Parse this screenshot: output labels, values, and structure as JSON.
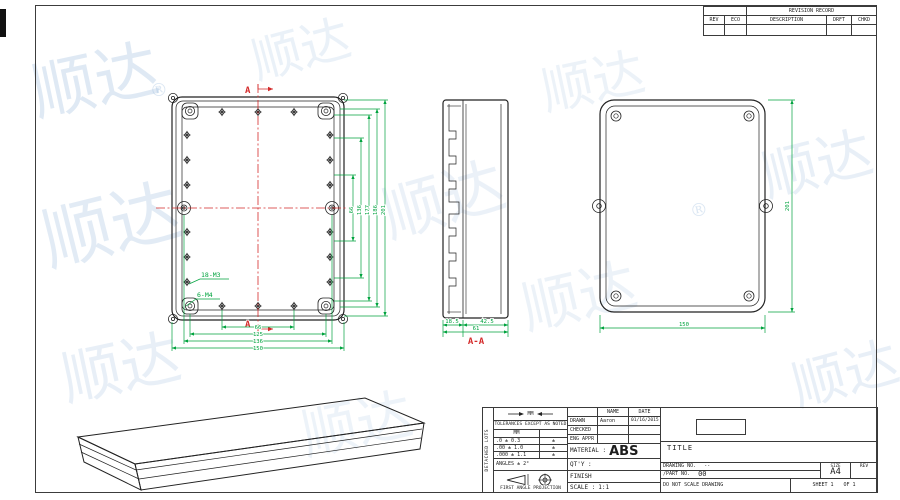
{
  "watermark": {
    "text": "顺达",
    "reg": "®"
  },
  "revision_table": {
    "title": "REVISION RECORD",
    "columns": [
      "REV",
      "ECO",
      "DESCRIPTION",
      "DRFT",
      "CHKD"
    ]
  },
  "views": {
    "front": {
      "label_m3": "18-M3",
      "label_m4": "6-M4",
      "section_marker": "A",
      "dims_bottom": [
        "66",
        "125",
        "136",
        "150"
      ],
      "dims_right": [
        "66",
        "136",
        "177",
        "186",
        "201"
      ]
    },
    "section": {
      "label": "A-A",
      "dim_left": "18.5",
      "dim_right": "42.5",
      "dim_total": "61"
    },
    "back": {
      "dim_height": "201",
      "dim_width": "150"
    }
  },
  "title_block": {
    "side_strip": "DETACHED LOTS",
    "datum_symbol": "MM",
    "tolerance_note": "TOLERANCES EXCEPT AS NOTED",
    "tol_header": "MM",
    "tol_rows": [
      {
        "spec": ".0 ± 0.3",
        "mark": "±"
      },
      {
        "spec": ".00 ± 1.0",
        "mark": "±"
      },
      {
        "spec": ".000 ± 1.1",
        "mark": "±"
      }
    ],
    "angles": "ANGLES ± 2°",
    "projection": "FIRST ANGLE PROJECTION",
    "info": {
      "name_header": "NAME",
      "date_header": "DATE",
      "drawn_label": "DRAWN",
      "drawn_name": "Aaron",
      "drawn_date": "01/16/2015",
      "checked_label": "CHECKED",
      "eng_label": "ENG APPR",
      "material_label": "MATERIAL :",
      "material_value": "ABS",
      "qty_label": "QT'Y :",
      "finish_label": "FINISH",
      "scale_label": "SCALE :",
      "scale_value": "1:1"
    },
    "right": {
      "title_label": "TITLE",
      "drawing_no_label": "DRAWING NO.",
      "drawing_no_value": "--",
      "part_no_label": "/PART NO.",
      "part_no_value": "00",
      "size_label": "SIZE",
      "size_value": "A4",
      "rev_label": "REV",
      "do_not_scale": "DO NOT SCALE DRAWING",
      "sheet_label": "SHEET 1",
      "of_label": "OF 1"
    }
  }
}
